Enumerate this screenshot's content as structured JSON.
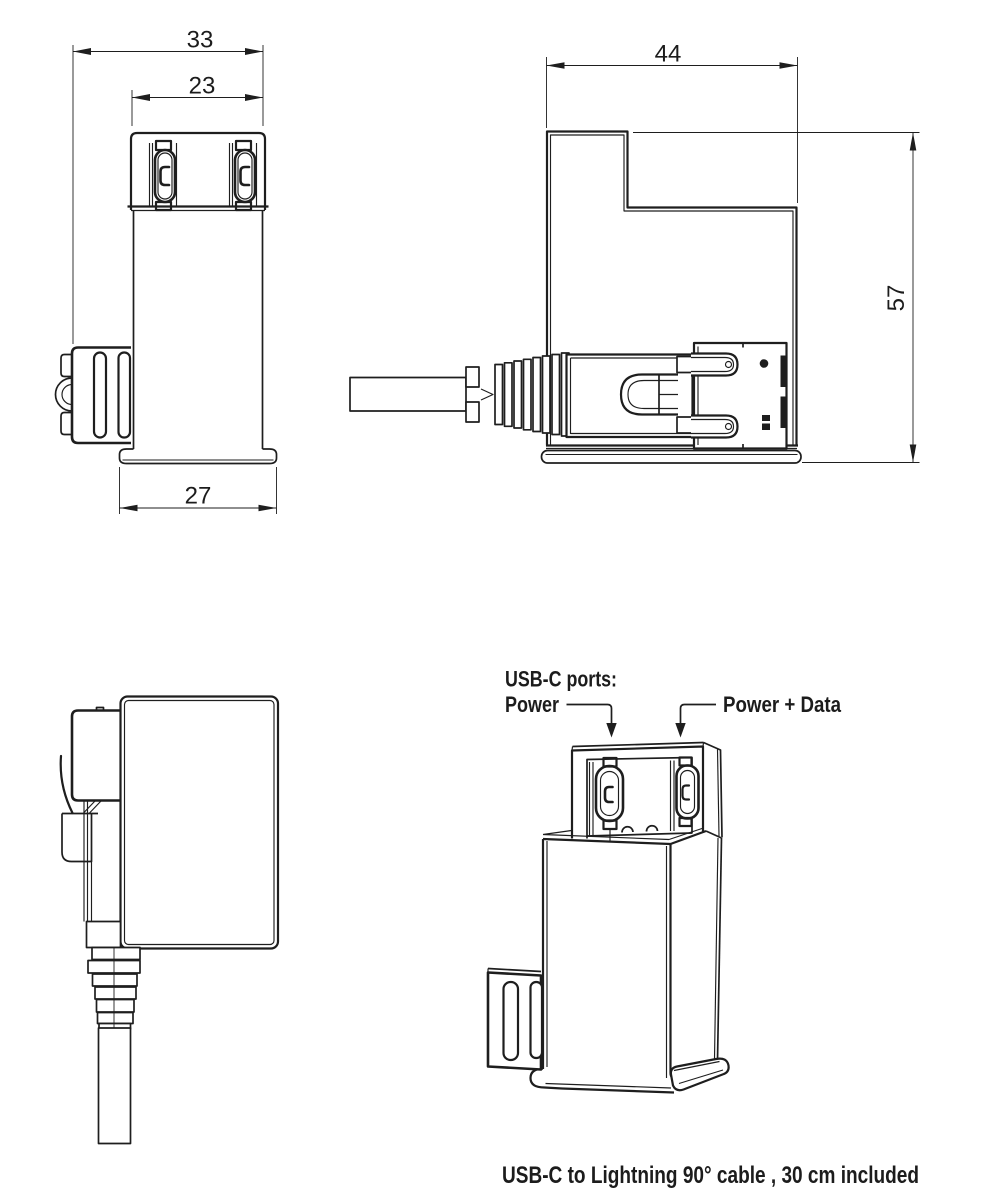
{
  "drawing": {
    "caption": "USB-C to Lightning 90° cable , 30 cm  included",
    "annotations": {
      "ports_heading": "USB-C ports:",
      "left_port": "Power",
      "right_port": "Power + Data"
    },
    "dimensions_mm": {
      "front_total_width": "33",
      "port_section_width": "23",
      "base_width": "27",
      "side_depth": "44",
      "side_height": "57"
    },
    "colors": {
      "line": "#1e1e1e",
      "background": "#ffffff"
    }
  }
}
